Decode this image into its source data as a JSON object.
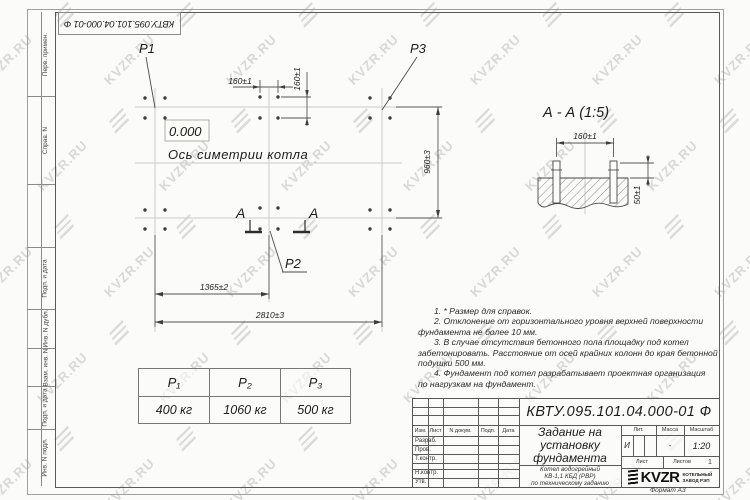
{
  "watermark": {
    "text": "KVZR.RU"
  },
  "frame": {
    "designation_top": "КВТУ.095.101.04.000-01 Ф",
    "left_labels": [
      "Перв. примен.",
      "Справ. N",
      "Подп. и дата",
      "Инв. N дубл.",
      "Взам. инв. N",
      "Подп. и дата",
      "Инв. N подл."
    ],
    "format_label": "Формат А3"
  },
  "plan": {
    "elevation": "0.000",
    "axis_label": "Ось симетрии котла",
    "p1": "P1",
    "p2": "P2",
    "p3": "P3",
    "section_letter": "А",
    "dims": {
      "top160": "160±1",
      "side160": "160±1",
      "v960": "960±3",
      "w1365": "1365±2",
      "w2810": "2810±3"
    }
  },
  "section": {
    "title": "А - А (1:5)",
    "d160": "160±1",
    "d50": "50±1"
  },
  "notes": {
    "lines": [
      "1. * Размер для справок.",
      "2. Отклонение от горизонтального уровня верхней поверхности",
      "фундамента не более 10 мм.",
      "3. В случае отсутствия бетонного пола площадку под котел",
      "забетонировать. Расстояние от осей крайних колонн до края бетонной",
      "подушки 500 мм.",
      "4. Фундамент под котел разрабатывает проектная организация",
      "по нагрузкам на фундамент."
    ]
  },
  "load_table": {
    "headers": [
      "P₁",
      "P₂",
      "P₃"
    ],
    "values": [
      "400 кг",
      "1060 кг",
      "500 кг"
    ]
  },
  "title_block": {
    "designation": "КВТУ.095.101.04.000-01 Ф",
    "doc_title_lines": [
      "Задание на",
      "установку",
      "фундамента"
    ],
    "subtitle_lines": [
      "Котел водогрейный",
      "КВ-1,1 КБД (РВР)",
      "по техническому заданию"
    ],
    "header_cols": [
      "Изм.",
      "Лист",
      "N докум.",
      "Подп.",
      "Дата"
    ],
    "row_labels": [
      "Разраб.",
      "Пров.",
      "Т.контр.",
      "Н.контр.",
      "Утв."
    ],
    "lit_header": "Лит.",
    "lit_value": "И",
    "mass_header": "Масса",
    "mass_value": "-",
    "scale_header": "Масштаб",
    "scale_value": "1:20",
    "sheet_label": "Лист",
    "sheets_label": "Листов",
    "sheets_value": "1",
    "company": "KVZR",
    "company_sub_lines": [
      "КОТЕЛЬНЫЙ",
      "ЗАВОД РЭП"
    ]
  }
}
